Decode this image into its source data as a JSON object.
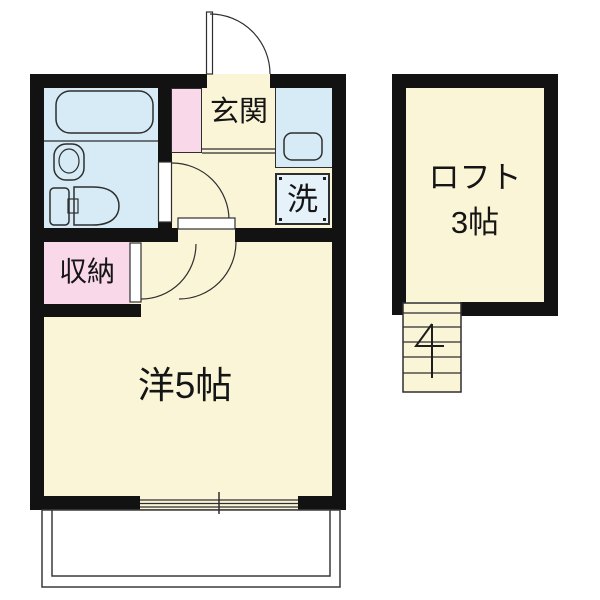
{
  "floorplan": {
    "labels": {
      "entrance": "玄関",
      "laundry": "洗",
      "storage": "収納",
      "main_room": "洋5帖",
      "loft_line1": "ロフト",
      "loft_line2": "3帖"
    },
    "colors": {
      "wall": "#121212",
      "floor_cream": "#FBF5D8",
      "wet_blue": "#D6EBF6",
      "laundry_blue": "#E6F2F9",
      "pink": "#F8D8E9",
      "line": "#2E2E2E",
      "background": "#FFFFFF"
    }
  }
}
